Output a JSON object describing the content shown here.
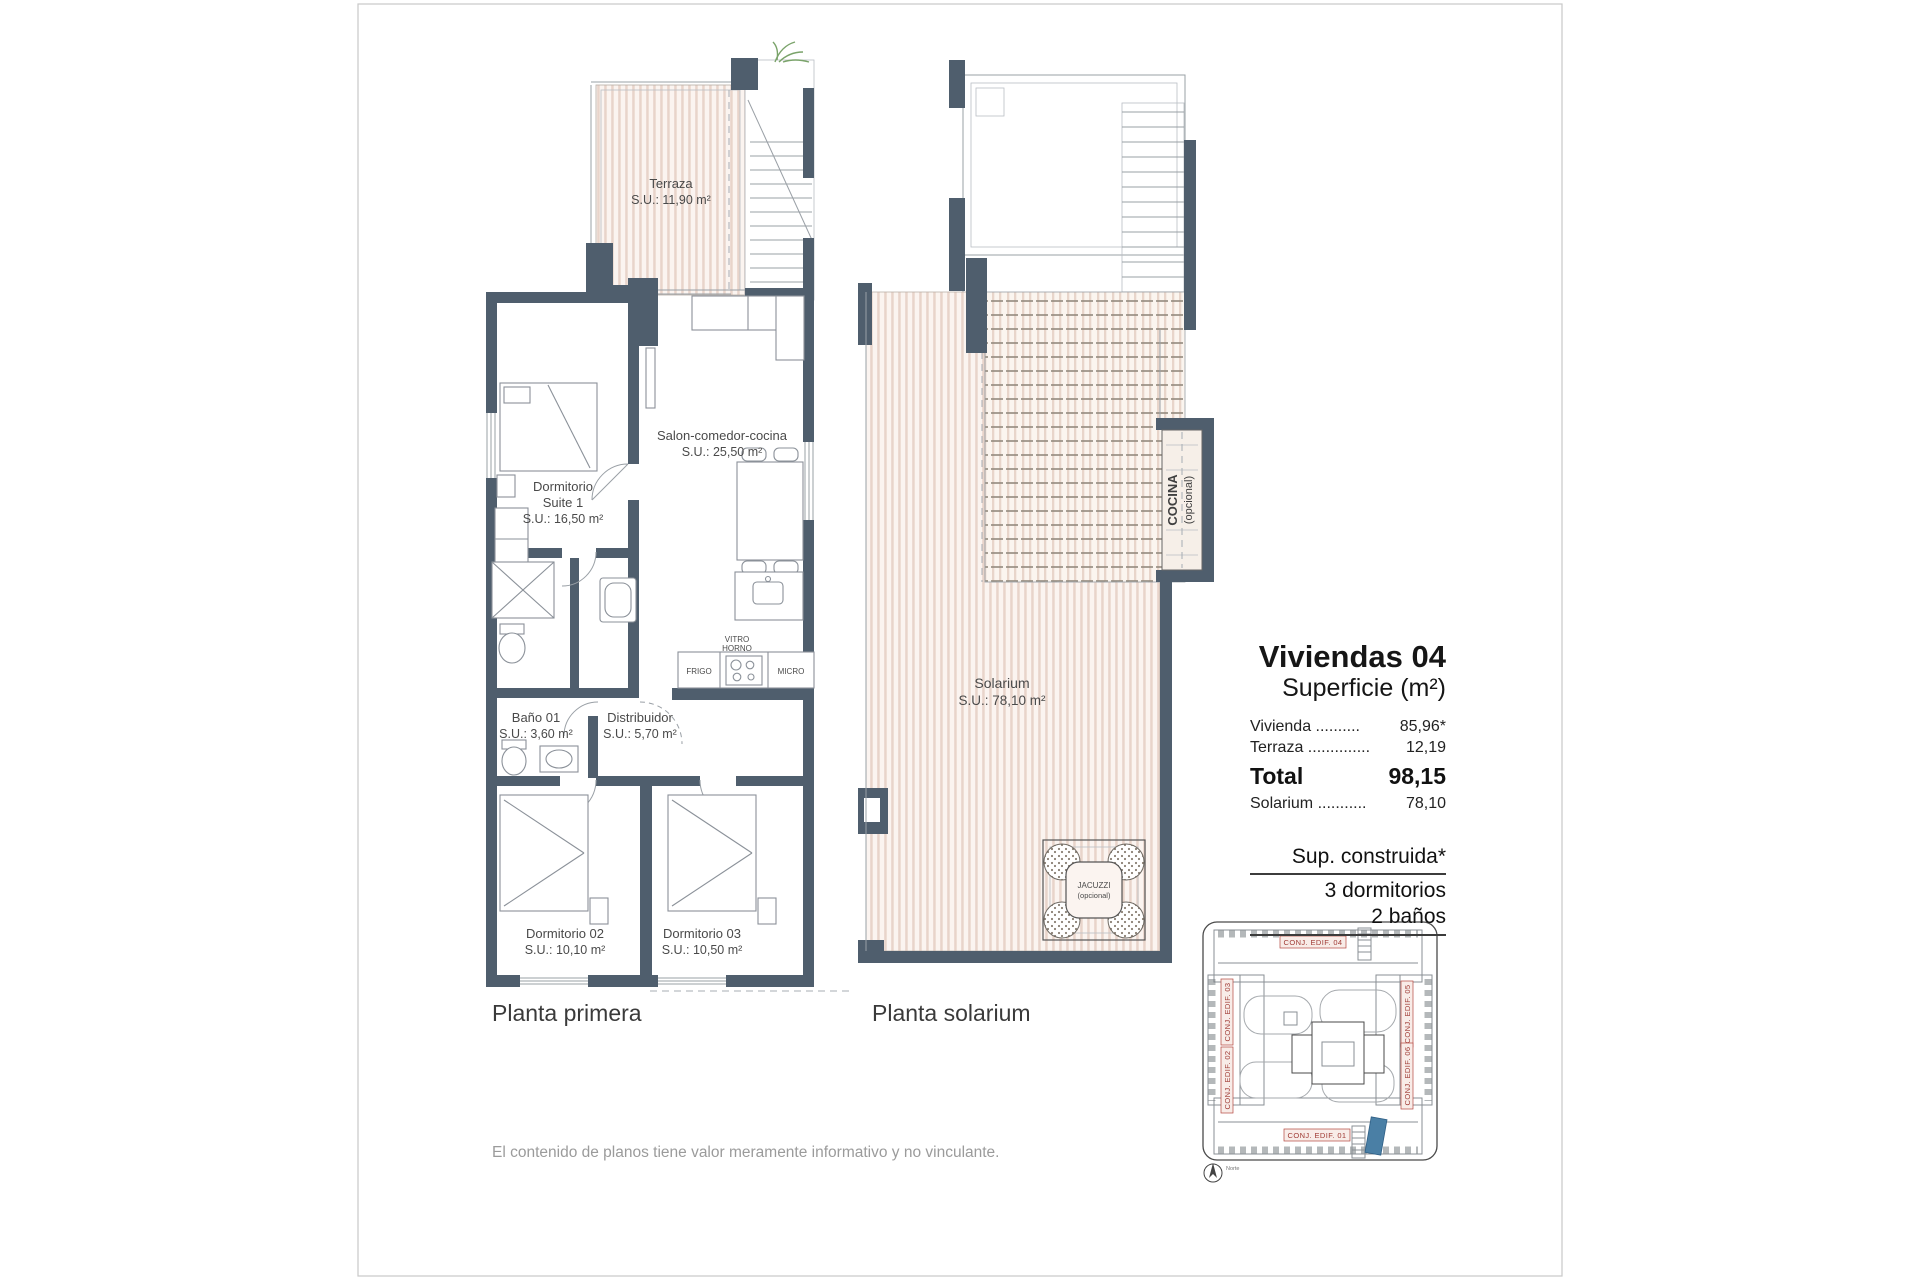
{
  "page": {
    "disclaimer": "El contenido de planos tiene valor meramente informativo y no vinculante."
  },
  "colors": {
    "wall": "#4f5e6d",
    "hatch_stripe": "#e8d4ca",
    "map_label_red": "#a03b35",
    "highlight_blue": "#4a7fa5",
    "plant_green": "#7aa36a"
  },
  "plans": {
    "primera": {
      "caption": "Planta primera",
      "terraza": {
        "name": "Terraza",
        "area": "S.U.: 11,90 m²"
      },
      "salon": {
        "name": "Salon-comedor-cocina",
        "area": "S.U.: 25,50 m²"
      },
      "suite1": {
        "line1": "Dormitorio",
        "line2": "Suite 1",
        "area": "S.U.: 16,50 m²"
      },
      "bano01": {
        "name": "Baño 01",
        "area": "S.U.: 3,60 m²"
      },
      "distribuidor": {
        "name": "Distribuidor",
        "area": "S.U.: 5,70 m²"
      },
      "dorm02": {
        "name": "Dormitorio 02",
        "area": "S.U.: 10,10 m²"
      },
      "dorm03": {
        "name": "Dormitorio 03",
        "area": "S.U.: 10,50 m²"
      },
      "kitchen": {
        "vitro": "VITRO",
        "horno": "HORNO",
        "frigo": "FRIGO",
        "micro": "MICRO"
      }
    },
    "solarium": {
      "caption": "Planta solarium",
      "solarium": {
        "name": "Solarium",
        "area": "S.U.: 78,10 m²"
      },
      "jacuzzi": {
        "line1": "JACUZZI",
        "line2": "(opcional)"
      },
      "cocina": {
        "line1": "COCINA",
        "line2": "(opcional)"
      }
    }
  },
  "info_panel": {
    "title": "Viviendas 04",
    "subtitle": "Superficie (m²)",
    "rows": [
      {
        "label": "Vivienda ..........",
        "value": "85,96*"
      },
      {
        "label": "Terraza ..............",
        "value": "12,19"
      }
    ],
    "total": {
      "label": "Total",
      "value": "98,15"
    },
    "solarium_row": {
      "label": "Solarium ...........",
      "value": "78,10"
    },
    "features": {
      "line1": "Sup. construida*",
      "line2": "3 dormitorios",
      "line3": "2 baños"
    }
  },
  "site_map": {
    "labels": {
      "top": "CONJ. EDIF. 04",
      "bottom": "CONJ. EDIF. 01",
      "left_upper": "CONJ. EDIF. 03",
      "left_lower": "CONJ. EDIF. 02",
      "right_upper": "CONJ. EDIF. 05",
      "right_lower": "CONJ. EDIF. 06"
    },
    "compass": "Norte"
  }
}
